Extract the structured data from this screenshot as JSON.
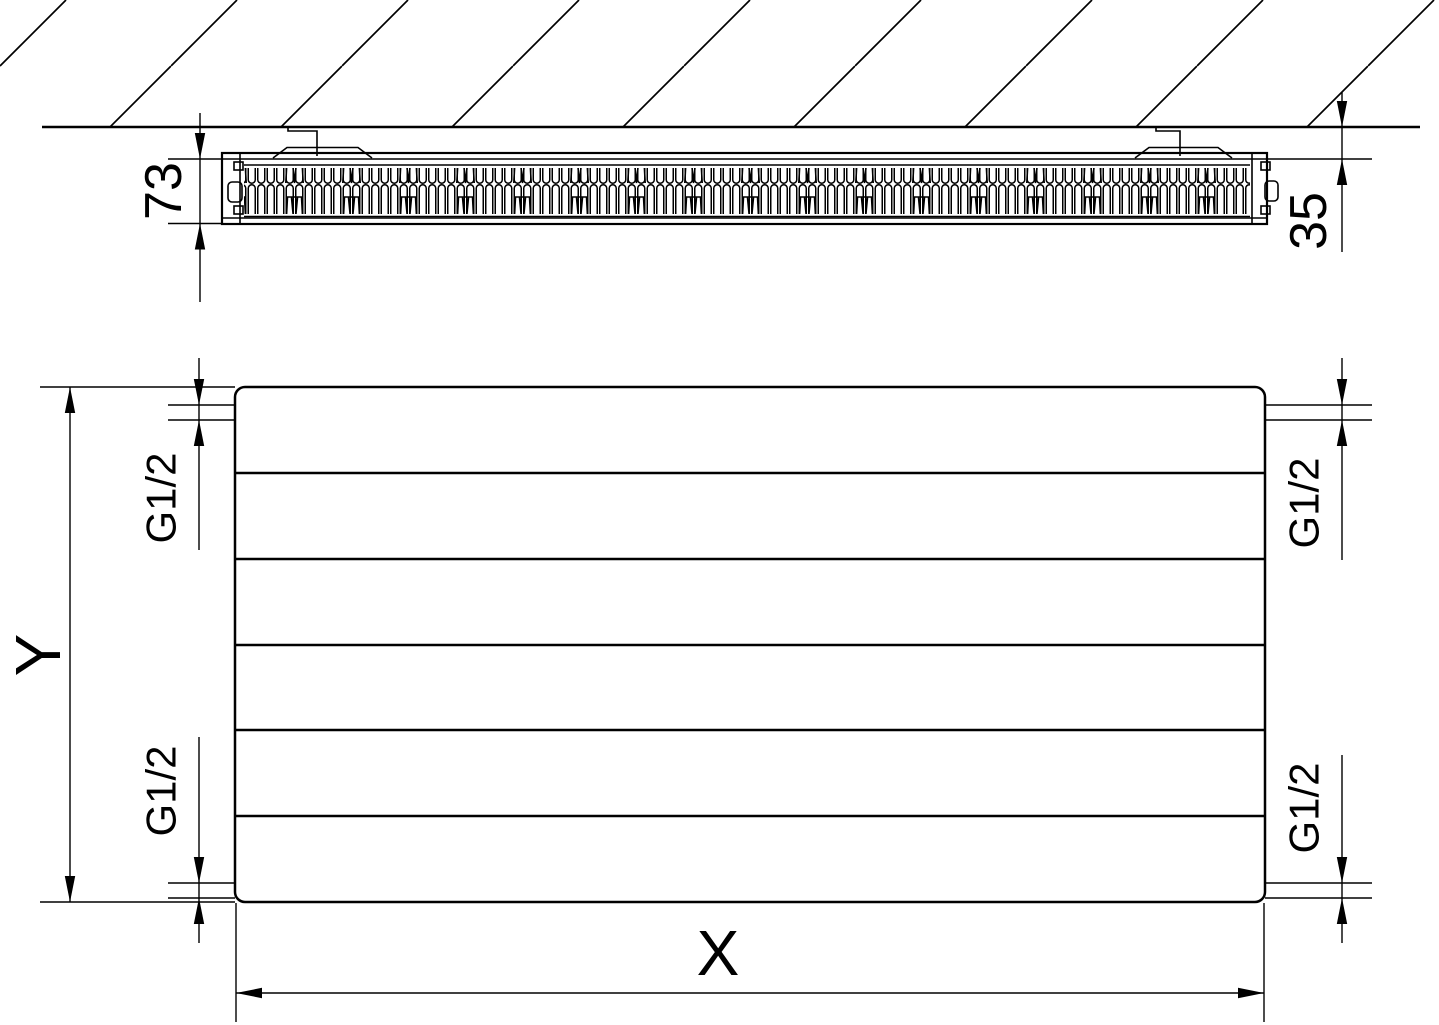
{
  "colors": {
    "line": "#000000",
    "background": "#ffffff",
    "text": "#000000"
  },
  "top_view": {
    "depth_label": "73",
    "wall_distance_label": "35"
  },
  "front_view": {
    "width_label": "X",
    "height_label": "Y",
    "connections": {
      "top_left": "G1/2",
      "top_right": "G1/2",
      "bottom_left": "G1/2",
      "bottom_right": "G1/2"
    }
  }
}
